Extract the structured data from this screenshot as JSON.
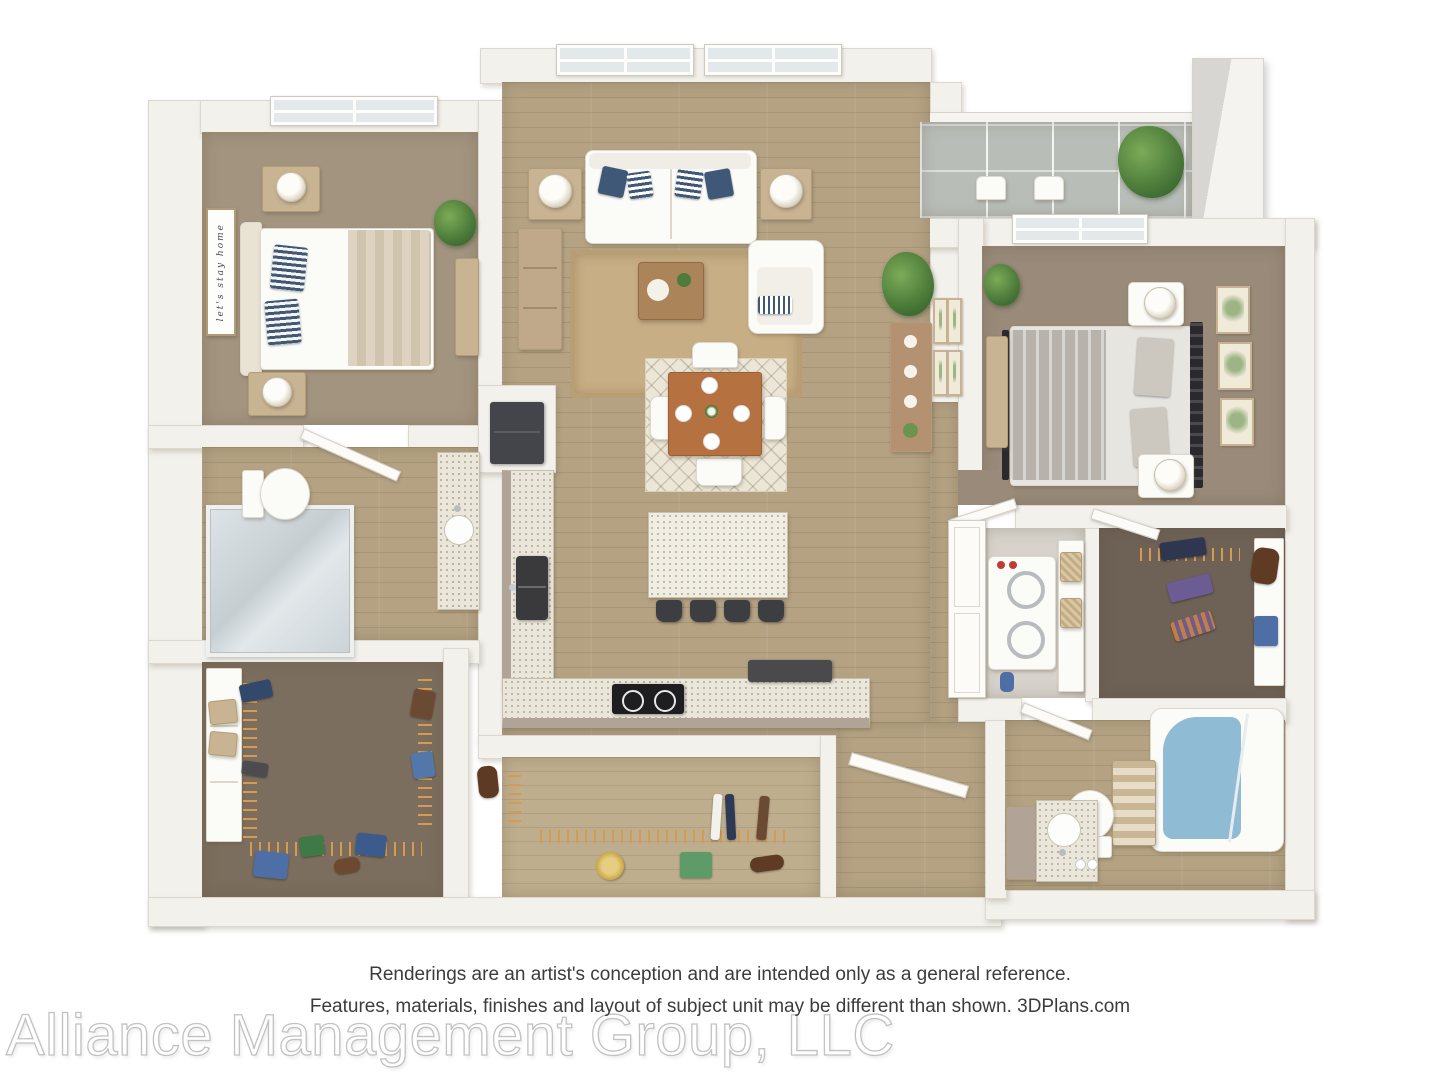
{
  "disclaimer": {
    "line1": "Renderings are an artist's conception and are intended only as a general reference.",
    "line2": "Features, materials, finishes and layout of subject unit may be different than shown. 3DPlans.com"
  },
  "watermark": "Alliance Management Group, LLC",
  "floorplan": {
    "wall_sign": "let's stay home",
    "rooms": [
      "living-room",
      "dining-area",
      "kitchen",
      "bedroom-1",
      "bedroom-2",
      "bathroom-1",
      "bathroom-2",
      "walk-in-closet-1",
      "walk-in-closet-2",
      "hall-closet",
      "laundry-closet",
      "entry",
      "screened-balcony"
    ],
    "colors": {
      "wall": "#f3f1ec",
      "wood_floor": "#b4a283",
      "carpet_bedroom1": "#a3947f",
      "carpet_bedroom2": "#998a79",
      "carpet_closet1": "#7c6e5e",
      "carpet_closet2": "#6e6156",
      "balcony_floor": "#b8bdb7",
      "countertop": "#eae6da",
      "cabinet": "#b1a496",
      "dining_table": "#b5713f",
      "jute_rug": "#c7ae85",
      "dining_rug": "#ece6d6",
      "accent_navy": "#3f5878",
      "tub_water": "#8fbcd4",
      "plant_green": "#4c7b3a",
      "appliance_dark": "#3c3e42",
      "hanger_orange": "#d79b4f"
    }
  }
}
